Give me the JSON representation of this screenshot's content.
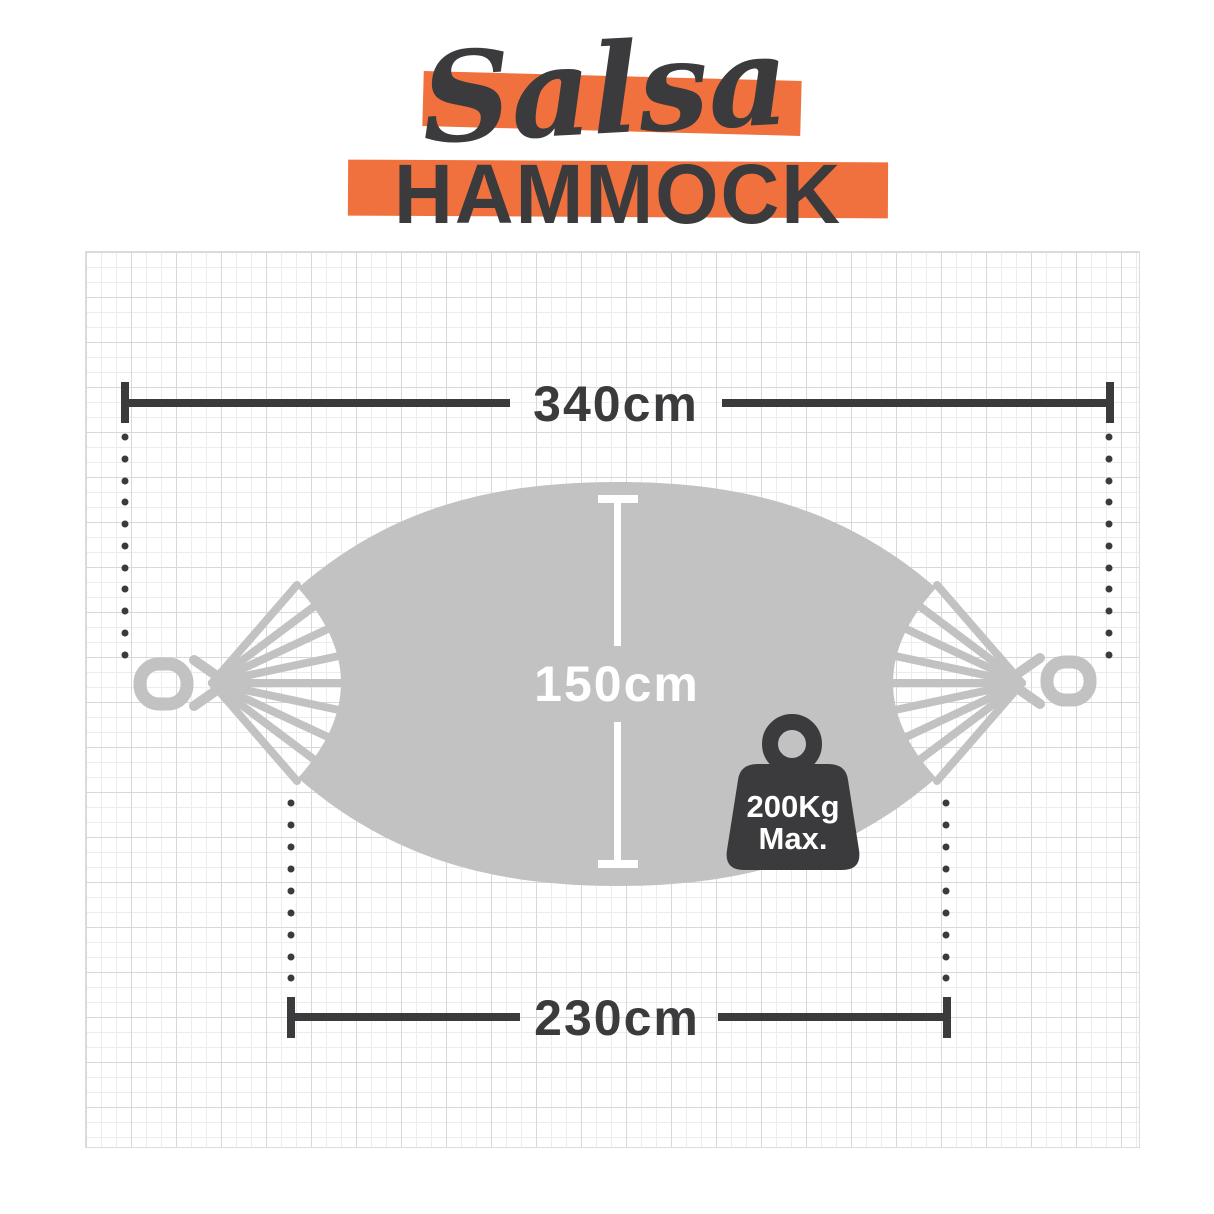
{
  "title": {
    "script": "Salsa",
    "main": "HAMMOCK"
  },
  "dimensions": {
    "total_length": "340cm",
    "bed_width": "150cm",
    "bed_length": "230cm"
  },
  "weight": {
    "line1": "200Kg",
    "line2": "Max."
  },
  "icons": {
    "weight_icon": "kettlebell-weight",
    "hammock_icon": "hammock-top-view"
  },
  "colors": {
    "accent_orange": "#F0713D",
    "ink_dark": "#3B3B3D",
    "fabric_gray": "#C2C2C2",
    "grid_major": "#D8D8D8",
    "grid_minor": "#ECECEC",
    "background": "#FFFFFF"
  }
}
